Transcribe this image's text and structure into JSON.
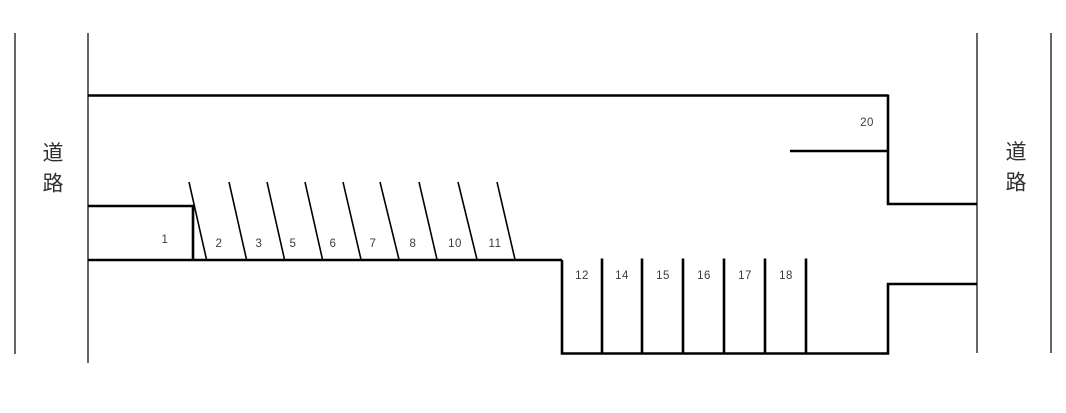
{
  "diagram": {
    "kind": "parking-lot-map",
    "roads": {
      "left_label": "道路",
      "right_label": "道路"
    },
    "spaces": {
      "s1": "1",
      "s2": "2",
      "s3": "3",
      "s5": "5",
      "s6": "6",
      "s7": "7",
      "s8": "8",
      "s10": "10",
      "s11": "11",
      "s12": "12",
      "s14": "14",
      "s15": "15",
      "s16": "16",
      "s17": "17",
      "s18": "18",
      "s20": "20"
    },
    "colors": {
      "line": "#000000",
      "space_label": "#3c3c3c",
      "road_label": "#2f2f2f",
      "background": "#ffffff"
    }
  }
}
